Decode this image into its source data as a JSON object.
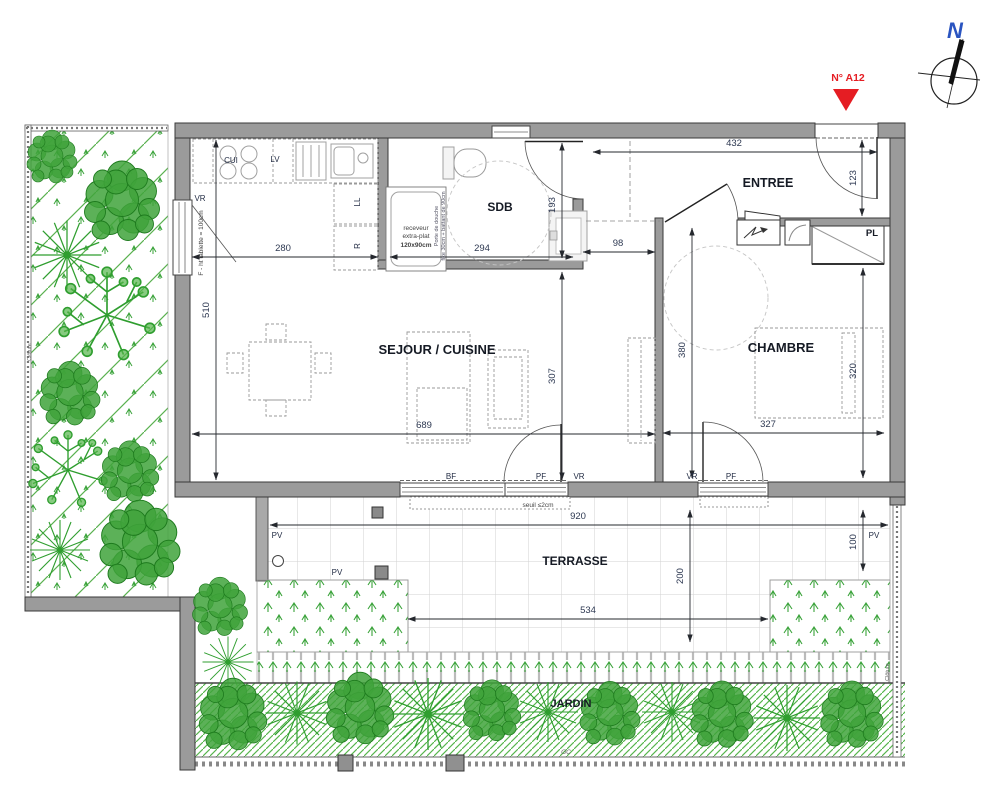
{
  "colors": {
    "wall_gray": "#9b9b9b",
    "accent_red": "#e51d23",
    "north_blue": "#2a54c0",
    "label_dark": "#151a24",
    "dim_color": "#2e3952",
    "vegetation_green": "#33a02c"
  },
  "labels": {
    "north": "N",
    "unit": "N° A12",
    "sejour": "SEJOUR / CUISINE",
    "chambre": "CHAMBRE",
    "sdb": "SDB",
    "entree": "ENTREE",
    "pl": "PL",
    "terrasse": "TERRASSE",
    "jardin": "JARDIN",
    "cui": "CUI",
    "lv": "LV",
    "ll": "LL",
    "r": "R",
    "vr_window": "VR",
    "window_note": "F - ht tablette = 100cm",
    "shower1": "receveur",
    "shower2": "extra-plat",
    "shower3": "120x90cm",
    "shower_door1": "Porte de douche",
    "shower_door2": "fixe 30cm + battant de 90cm",
    "bf": "BF",
    "pf_sejour": "PF",
    "vr_sejour": "VR",
    "vr_chambre": "VR",
    "pf_chambre": "PF",
    "seuil": "seuil ≤2cm",
    "pv_left": "PV",
    "pv_mid": "PV",
    "pv_right": "PV",
    "cloture_left": "Clôture",
    "cloture_right": "Clôture",
    "gc": "GC"
  },
  "dims": {
    "d432": "432",
    "d123": "123",
    "d280": "280",
    "d294": "294",
    "d193": "193",
    "d98": "98",
    "d510": "510",
    "d307": "307",
    "d689": "689",
    "d327": "327",
    "d380": "380",
    "d320": "320",
    "d920": "920",
    "d534": "534",
    "d200": "200",
    "d100": "100"
  },
  "vegetation": {
    "trees": [
      [
        52,
        158,
        1.0,
        "leafy"
      ],
      [
        122,
        203,
        1.5,
        "leafy"
      ],
      [
        67,
        255,
        1.15,
        "radial"
      ],
      [
        107,
        315,
        1.65,
        "branchy"
      ],
      [
        70,
        395,
        1.2,
        "leafy"
      ],
      [
        68,
        470,
        1.35,
        "branchy"
      ],
      [
        130,
        473,
        1.15,
        "leafy"
      ],
      [
        60,
        550,
        1.0,
        "radial"
      ],
      [
        140,
        545,
        1.6,
        "leafy"
      ],
      [
        220,
        608,
        1.1,
        "leafy"
      ],
      [
        228,
        662,
        0.85,
        "radial"
      ],
      [
        233,
        716,
        1.35,
        "leafy"
      ],
      [
        297,
        713,
        1.05,
        "radial"
      ],
      [
        360,
        710,
        1.35,
        "leafy"
      ],
      [
        428,
        714,
        1.2,
        "radial"
      ],
      [
        492,
        712,
        1.15,
        "leafy"
      ],
      [
        548,
        712,
        1.0,
        "radial"
      ],
      [
        610,
        715,
        1.2,
        "leafy"
      ],
      [
        672,
        712,
        1.0,
        "radial"
      ],
      [
        722,
        716,
        1.25,
        "leafy"
      ],
      [
        787,
        718,
        1.1,
        "radial"
      ],
      [
        852,
        716,
        1.25,
        "leafy"
      ]
    ]
  }
}
